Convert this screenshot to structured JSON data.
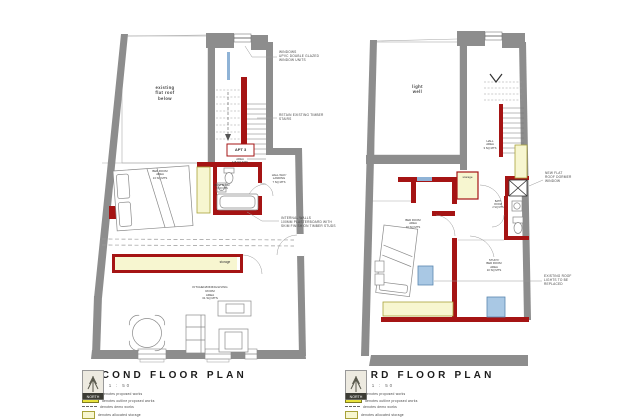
{
  "colors": {
    "proposed_red": "#a51414",
    "outline_yellow": "#e8e23c",
    "storage_fill": "#f7f6d0",
    "storage_border": "#a8a23a",
    "wall_grey": "#8d8d8d",
    "glazing_blue": "#8fb3d6",
    "rooflight_blue": "#a9c8e4"
  },
  "plans": {
    "second": {
      "title": "SECOND FLOOR PLAN",
      "scale": "SCALE 1 : 50",
      "labels": {
        "flat_roof": "existing\nflat roof\nbelow",
        "apt_tag": "APT 3",
        "apt_area": "AREA\n115 SQ MTS",
        "bedroom": "BED ROOM\nAREA\n13 SQ MTS",
        "bathroom": "BATH ROOM\n3 SQ MTS",
        "hall": "HALL WAY/\nLANDING\n7 SQ MTS",
        "storage": "storage",
        "living": "KITCHEN/DINING/LIVING\nROOM\nAREA\n31 SQ MTS"
      },
      "annotations": {
        "windows": "WINDOWS\nUPVC DOUBLE GLAZED\nWINDOW UNITS",
        "stairs": "RETAIN EXISTING TIMBER\nSTAIRS",
        "internal_walls": "INTERNAL WALLS\n100MM PLASTERBOARD WITH\nSKIM FINISH ON TIMBER STUDS"
      }
    },
    "third": {
      "title": "THIRD FLOOR PLAN",
      "scale": "SCALE 1 : 50",
      "labels": {
        "light_well": "light\nwell",
        "hall": "HALL\nAREA\n3 SQ MTS",
        "storage": "storage",
        "bedroom": "BED ROOM\nAREA\n10 SQ MTS",
        "study": "STUDY/\nBED ROOM\nAREA\n10 SQ MTS",
        "bathroom": "BATH\nROOM\n2 SQ MTS"
      },
      "annotations": {
        "dormer": "NEW FLAT\nROOF DORMER\nWINDOW",
        "rooflights": "EXISTING ROOF\nLIGHTS TO BE\nREPLACED"
      }
    }
  },
  "legend": {
    "items": [
      {
        "key": "proposed",
        "label": "denotes  proposed works"
      },
      {
        "key": "outline",
        "label": "denotes  outline proposed works"
      },
      {
        "key": "demo",
        "label": "denotes  demo works"
      },
      {
        "key": "storage",
        "label": "denotes  allocated storage"
      }
    ]
  },
  "logo": {
    "text": "NORTH"
  }
}
